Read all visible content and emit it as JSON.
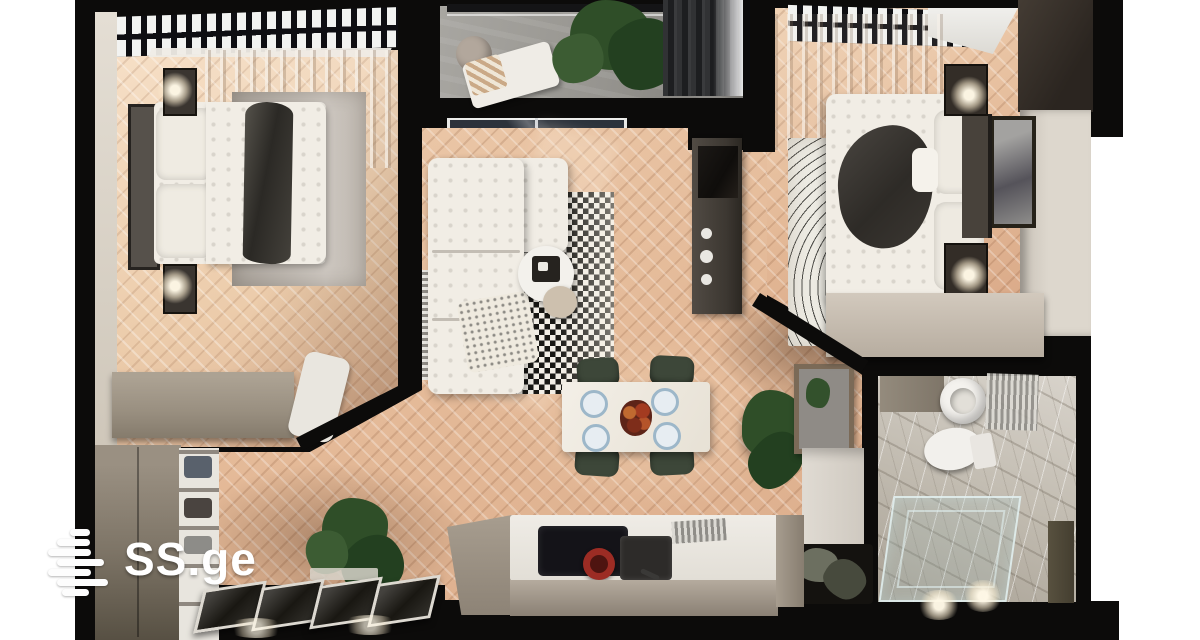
{
  "watermark": {
    "text": "SS.ge",
    "color": "#ffffff",
    "logo": "ss-ge-stacked-bars-logo"
  },
  "scene": {
    "kind": "top-down 3d apartment floor plan render",
    "rooms_depicted": [
      "bedroom-left",
      "balcony",
      "living-room",
      "bedroom-right",
      "bathroom",
      "kitchen",
      "dining-area",
      "hallway-entry"
    ],
    "objects_depicted": [
      "double-bed",
      "sectional-sofa",
      "checkered-rug",
      "fingerprint-rug",
      "coffee-table",
      "dining-table-with-4-plates",
      "dining-chairs",
      "kitchen-island",
      "induction-hob",
      "red-pot",
      "sink",
      "toilet",
      "round-basin",
      "shower-enclosure",
      "wardrobe",
      "shoe-shelf",
      "potted-plants",
      "wall-lamps",
      "picture-frames"
    ]
  },
  "palette": {
    "outer": "#ffffff",
    "wall": "#0c0b0a",
    "wall_beige": "#dcd5cb",
    "wall_dark_brown": "#362f29",
    "parquet_warm": "#e3b996",
    "parquet_pale": "#eed3b7",
    "concrete": "#9d9b96",
    "taupe": "#9c9285",
    "white_soft": "#f1ede5",
    "rug_gray": "#b7b0a8",
    "rug_black": "#181714",
    "rug_white": "#f2eee6",
    "marble": "#c9c3ba",
    "green_dark": "#234020",
    "green_mid": "#2f4e28",
    "green_chair": "#3d4739",
    "red_pot": "#9c2c24",
    "plate_blue": "#9db7c9",
    "glass": "#2c323b"
  }
}
